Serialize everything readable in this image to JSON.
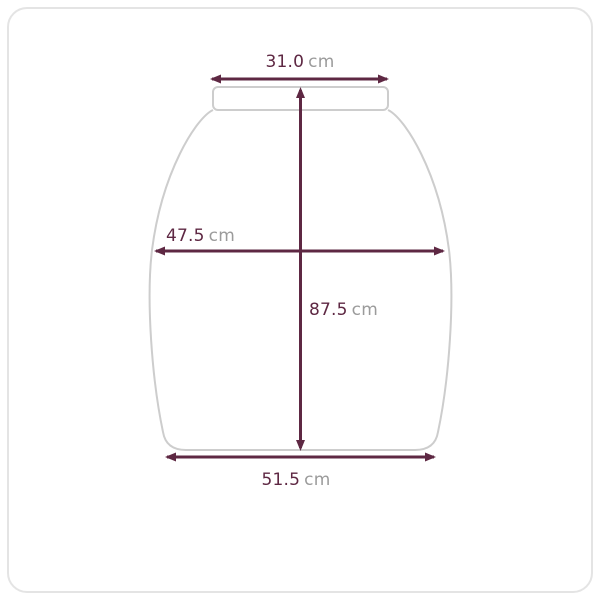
{
  "colors": {
    "accent": "#5e2843",
    "unit_text": "#9b9b9b",
    "outline": "#cdcdcd",
    "card_border": "#e4e4e4",
    "background": "#ffffff"
  },
  "diagram": {
    "subject": "garment-measurement-diagram",
    "measurements": {
      "top_width": {
        "value": "31.0",
        "unit": "cm"
      },
      "middle_width": {
        "value": "47.5",
        "unit": "cm"
      },
      "length": {
        "value": "87.5",
        "unit": "cm"
      },
      "bottom_width": {
        "value": "51.5",
        "unit": "cm"
      }
    }
  }
}
